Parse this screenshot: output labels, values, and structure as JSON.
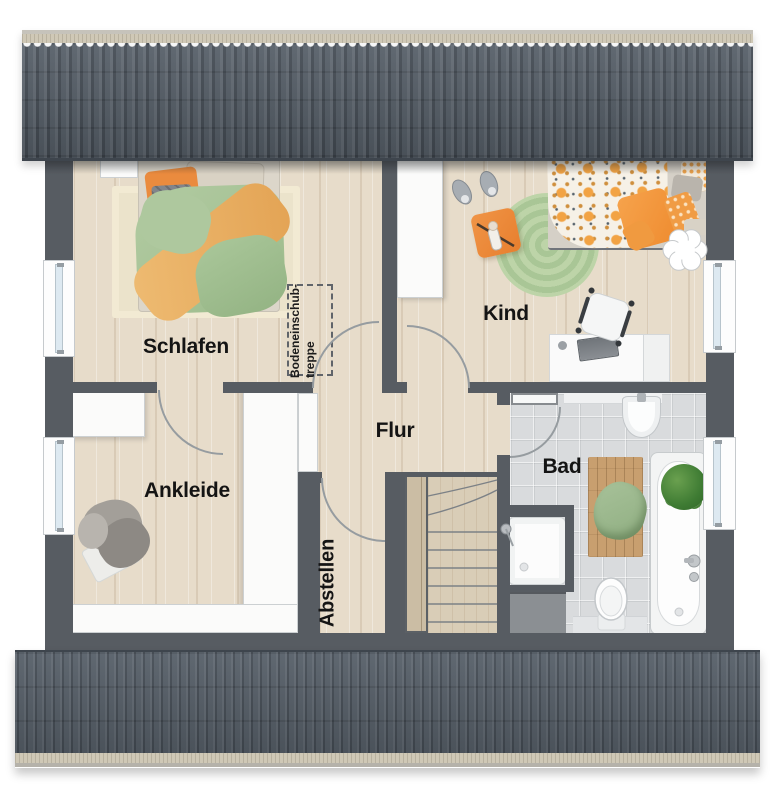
{
  "plan": {
    "rooms": {
      "schlafen": {
        "label": "Schlafen"
      },
      "ankleide": {
        "label": "Ankleide"
      },
      "kind": {
        "label": "Kind"
      },
      "flur": {
        "label": "Flur"
      },
      "bad": {
        "label": "Bad"
      },
      "abstellen": {
        "label": "Abstellen"
      }
    },
    "annotations": {
      "attic_hatch_stairs": {
        "line1": "Bodeneinschub-",
        "line2": "treppe"
      }
    },
    "colors": {
      "wall": "#575c62",
      "roof_tiles": "#505963",
      "roof_fascia": "#cfc8b6",
      "floor_wood": "#e7dcca",
      "bath_tile": "#d9dbdd",
      "stair_wood": "#d9cdb7",
      "accent_orange": "#ed8a3d",
      "accent_green": "#a8c79a",
      "window_glass": "#dde9f1"
    }
  }
}
